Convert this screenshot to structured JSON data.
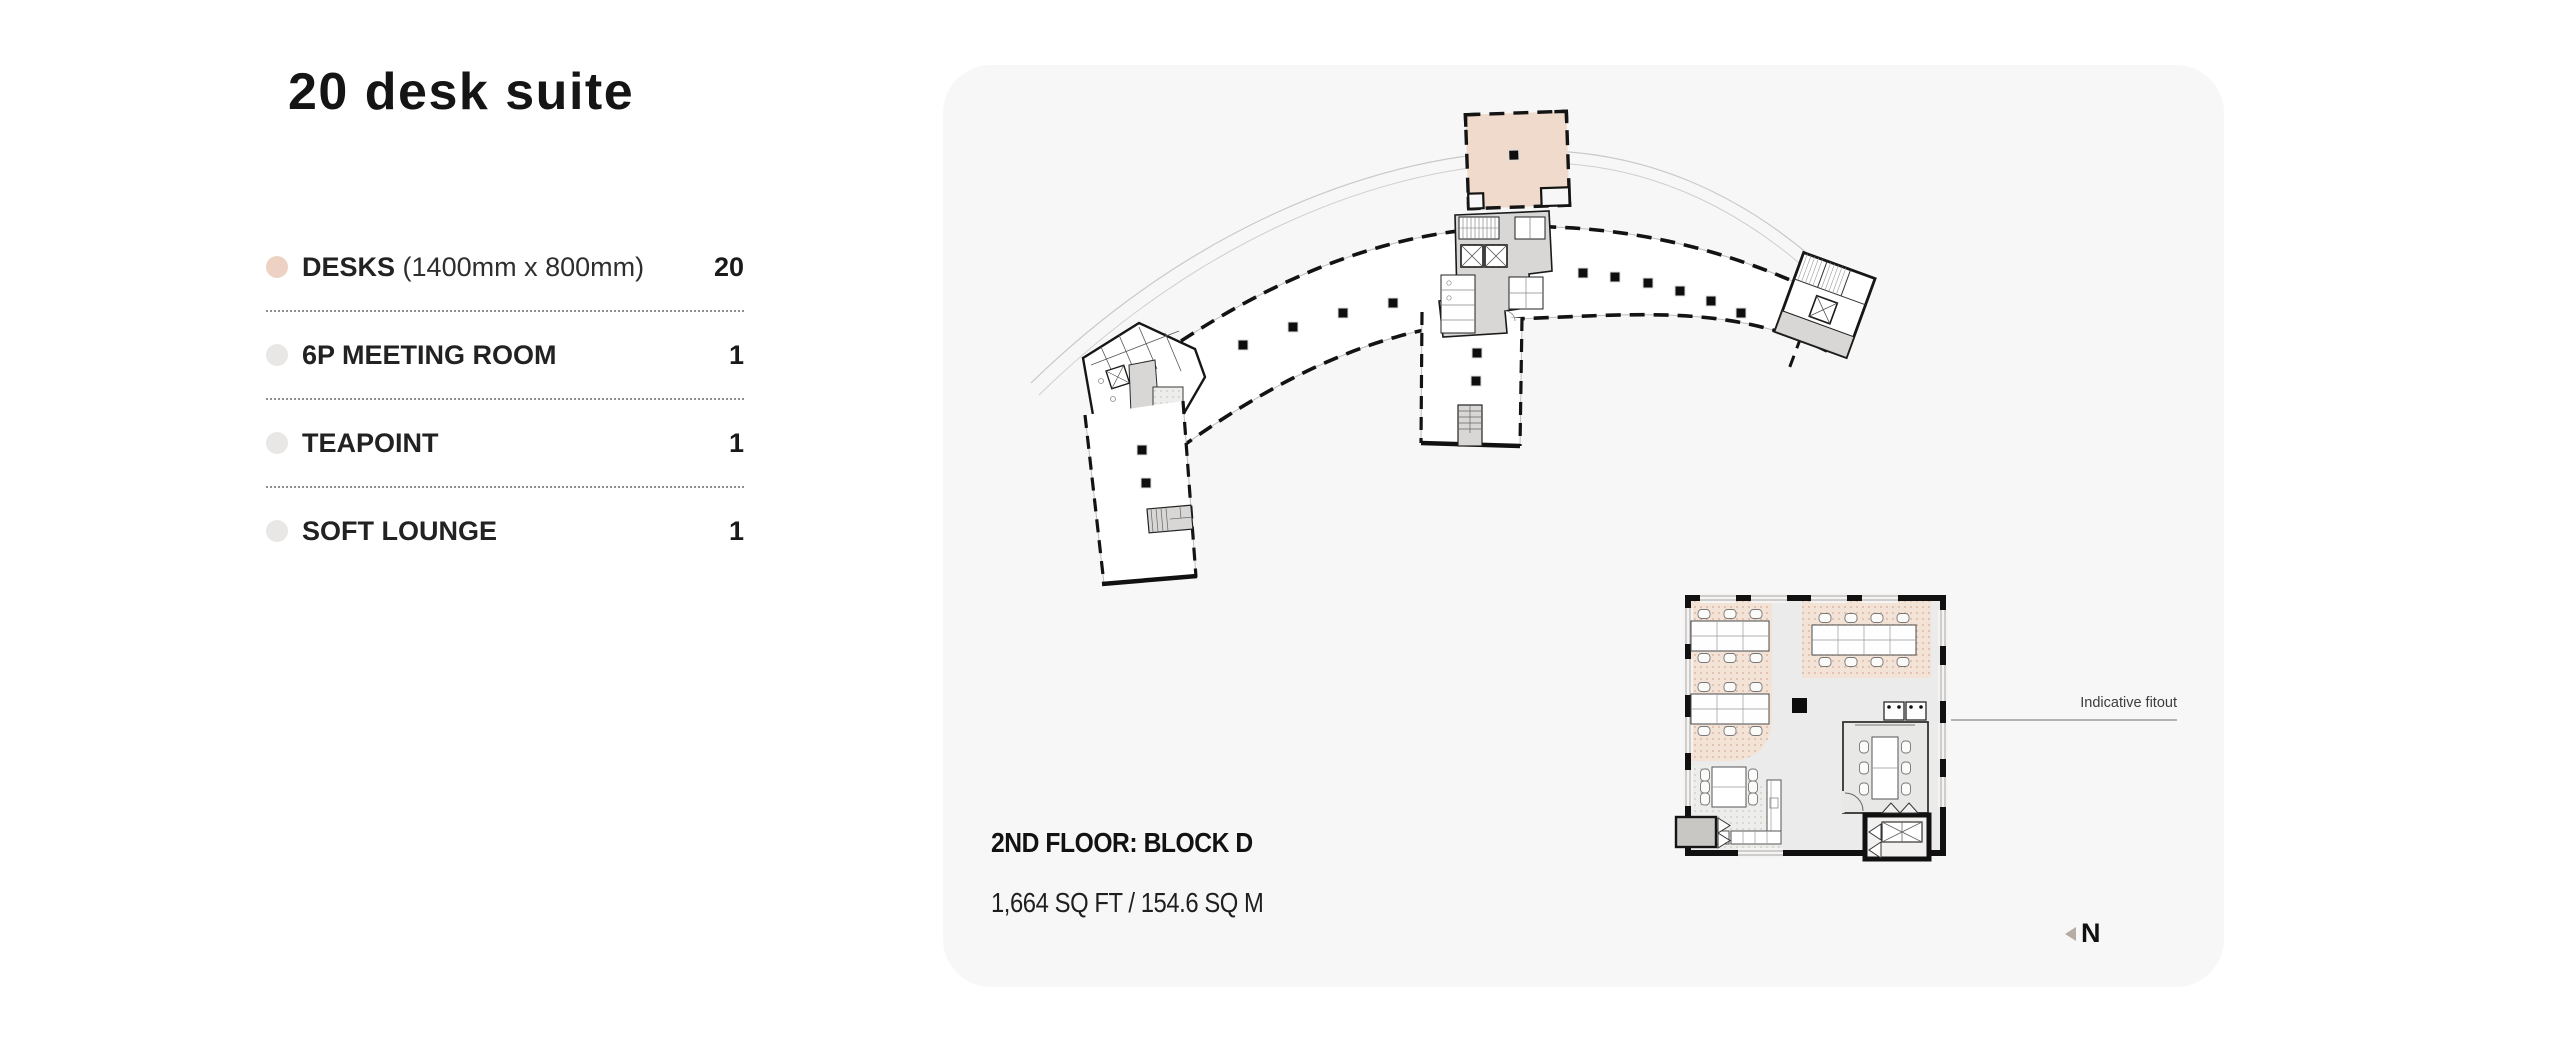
{
  "page": {
    "title": "20 desk suite"
  },
  "legend": {
    "items": [
      {
        "label": "DESKS",
        "detail": "(1400mm x 800mm)",
        "value": "20"
      },
      {
        "label": "6P MEETING ROOM",
        "detail": "",
        "value": "1"
      },
      {
        "label": "TEAPOINT",
        "detail": "",
        "value": "1"
      },
      {
        "label": "SOFT LOUNGE",
        "detail": "",
        "value": "1"
      }
    ]
  },
  "plan": {
    "floor_label": "2ND FLOOR: BLOCK D",
    "area_label": "1,664 SQ FT / 154.6 SQ M",
    "fitout_label": "Indicative fitout",
    "north_label": "N"
  },
  "colors": {
    "highlight_peach": "#F0DACB",
    "legend_dot_desks": "#EDD2C3",
    "legend_dot_neutral": "#E9E7E5",
    "panel_background": "#F7F7F7",
    "ink": "#1A1A1A"
  }
}
